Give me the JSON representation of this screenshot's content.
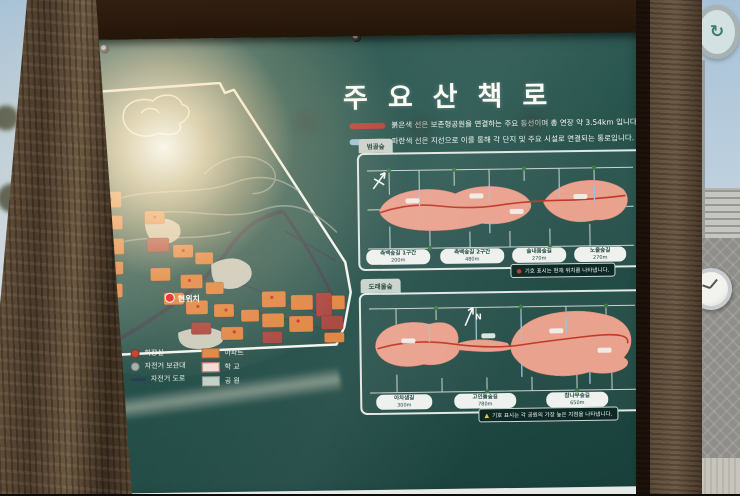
{
  "colors": {
    "panel_teal": "#2a5650",
    "frame_brown": "#4a3a2a",
    "apartment_orange": "#e08340",
    "trail_red": "#b8403a",
    "trail_blue": "#9cc4dc",
    "park_salmon": "#e9a28e",
    "sky_blue": "#b5cadb"
  },
  "sign": {
    "title": "주요산책로",
    "intro": [
      {
        "swatch_color": "#b8403a",
        "text": "붉은색 선은 보존형공원을 연결하는 주요 동선이며 총 연장 약 3.54km 입니다."
      },
      {
        "swatch_color": "#9cc4dc",
        "text": "파란색 선은 지선으로 이를 통해 각 단지 및 주요 시설로 연결되는 통로입니다."
      }
    ],
    "left_map": {
      "current_location": "현위치",
      "legend_col1": [
        {
          "icon": "restroom-dot",
          "label": "화장실"
        },
        {
          "icon": "bike-rack-dot",
          "label": "자전거 보관대"
        },
        {
          "icon": "bike-road-line",
          "label": "자전거 도로"
        }
      ],
      "legend_col2": [
        {
          "swatch": "#e08340",
          "label": "아파트"
        },
        {
          "swatch": "#f0dcd8",
          "label": "학 교"
        },
        {
          "swatch": "#c2cfc6",
          "label": "공 원"
        }
      ]
    },
    "trail_maps": [
      {
        "tab": "범골숲",
        "segments": [
          {
            "name": "측백숲길 1구간",
            "distance": "200m"
          },
          {
            "name": "측백숲길 2구간",
            "distance": "480m"
          },
          {
            "name": "솔내음숲길",
            "distance": "270m"
          },
          {
            "name": "노을숲길",
            "distance": "270m"
          }
        ],
        "note": {
          "marker": "●",
          "marker_color": "#c0392b",
          "text": "기호 표시는 현재 위치를 나타냅니다."
        }
      },
      {
        "tab": "도래울숲",
        "segments": [
          {
            "name": "아차샘길",
            "distance": "300m"
          },
          {
            "name": "고인돌숲길",
            "distance": "780m"
          },
          {
            "name": "참나무숲길",
            "distance": "650m"
          }
        ],
        "note": {
          "marker": "▲",
          "marker_color": "#e8c93f",
          "text": "기호 표시는 각 공원의 가장 높은 지점을 나타냅니다."
        }
      }
    ]
  }
}
